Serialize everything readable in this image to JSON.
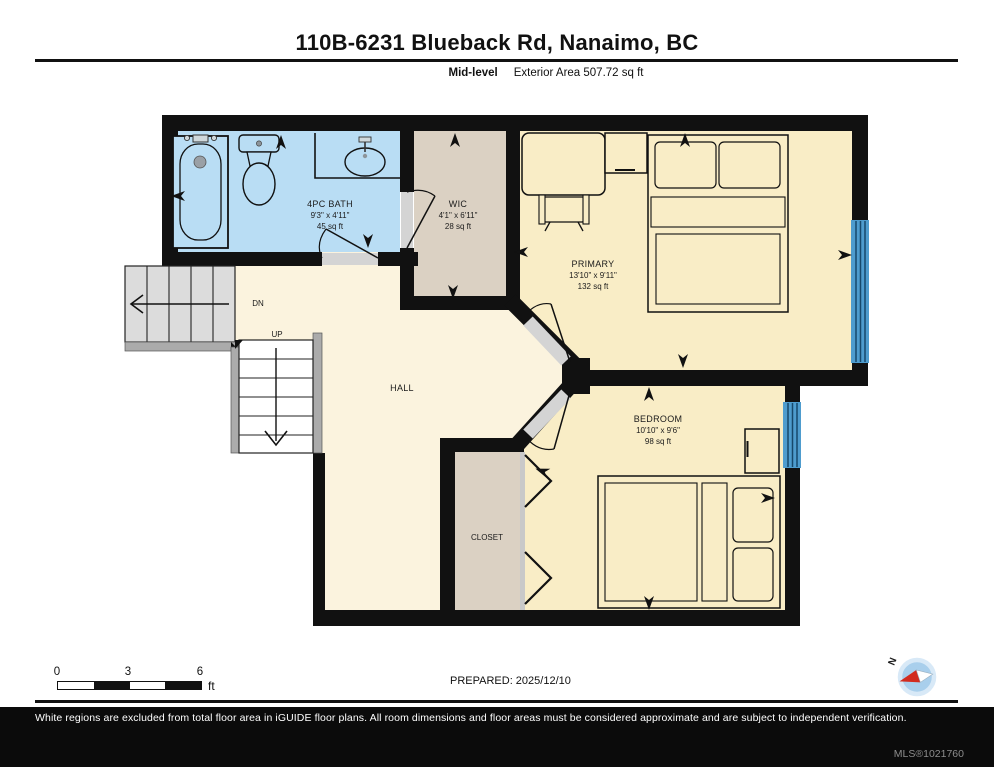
{
  "header": {
    "title": "110B-6231 Blueback Rd, Nanaimo, BC",
    "level_label": "Mid-level",
    "area_label": "Exterior Area 507.72 sq ft"
  },
  "rooms": {
    "bath": {
      "name": "4PC BATH",
      "dims": "9'3\" x 4'11\"",
      "area": "45 sq ft"
    },
    "wic": {
      "name": "WIC",
      "dims": "4'1\" x 6'11\"",
      "area": "28 sq ft"
    },
    "primary": {
      "name": "PRIMARY",
      "dims": "13'10\" x 9'11\"",
      "area": "132 sq ft"
    },
    "bedroom": {
      "name": "BEDROOM",
      "dims": "10'10\" x 9'6\"",
      "area": "98 sq ft"
    },
    "hall": {
      "name": "HALL"
    },
    "closet": {
      "name": "CLOSET"
    }
  },
  "stairs": {
    "down_label": "DN",
    "up_label": "UP"
  },
  "scale_bar": {
    "tick_0": "0",
    "tick_3": "3",
    "tick_6": "6",
    "unit": "ft"
  },
  "prepared_label": "PREPARED: 2025/12/10",
  "compass": {
    "north_label": "N"
  },
  "footer": {
    "disclaimer": "White regions are excluded from total floor area in iGUIDE floor plans. All room dimensions and floor areas must be considered approximate and are subject to independent verification.",
    "mls": "MLS®1021760"
  },
  "colors": {
    "wall": "#111111",
    "room_floor": "#F9EDC6",
    "hall_floor": "#FBF3DE",
    "closet_floor": "#DBD1C3",
    "bath_floor": "#B9DDF4",
    "window": "#4E9CCE",
    "stair_tread": "#DCDCDC",
    "stringer": "#ABABAB"
  }
}
